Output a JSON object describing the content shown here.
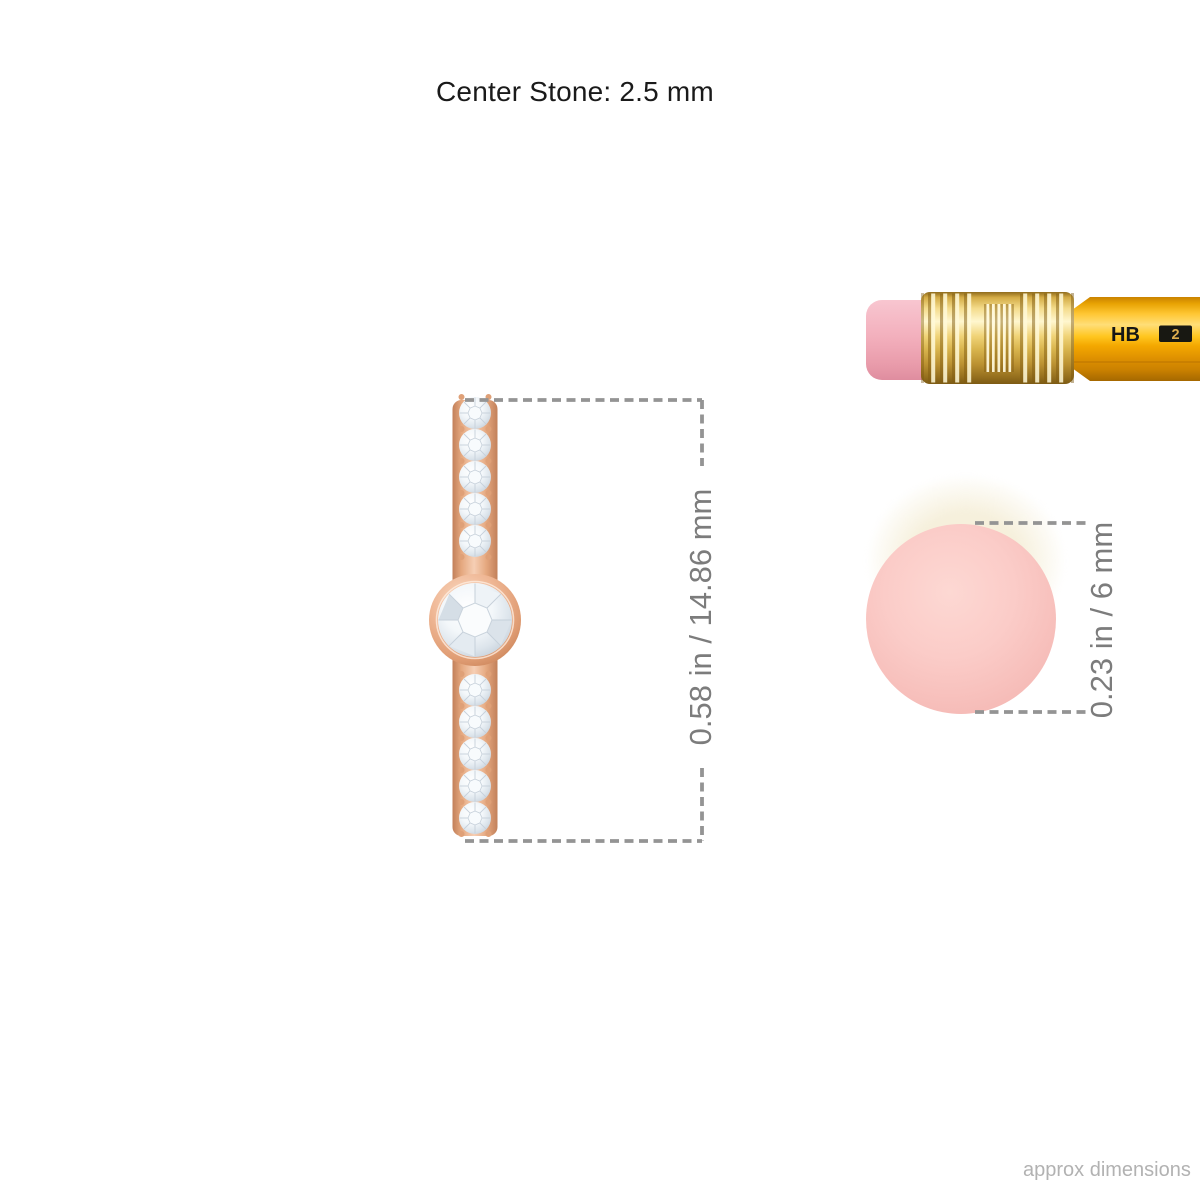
{
  "header": {
    "title": "Center Stone: 2.5 mm"
  },
  "dimensions": {
    "earring_height_label": "0.58 in / 14.86 mm",
    "eraser_diameter_label": "0.23 in / 6 mm"
  },
  "pencil": {
    "grade_label": "HB",
    "grade_number": "2"
  },
  "jewelry": {
    "pave_stones_above": 5,
    "pave_stones_below": 5,
    "center_stone_setting": "bezel"
  },
  "footer": {
    "note": "approx dimensions"
  },
  "colors": {
    "rose_gold": "#e8a87e",
    "rose_gold_deep": "#c98257",
    "diamond_facet": "#c6d0da",
    "pencil_yellow": "#fdb913",
    "ferrule_gold": "#f0d377",
    "eraser_pink": "#f3b0bd",
    "eraser_end_pink": "#fbccc8",
    "dimension_line": "#949494",
    "dimension_text": "#7c7c7c",
    "title_text": "#1a1a1a",
    "footer_text": "#b2b2b2"
  }
}
